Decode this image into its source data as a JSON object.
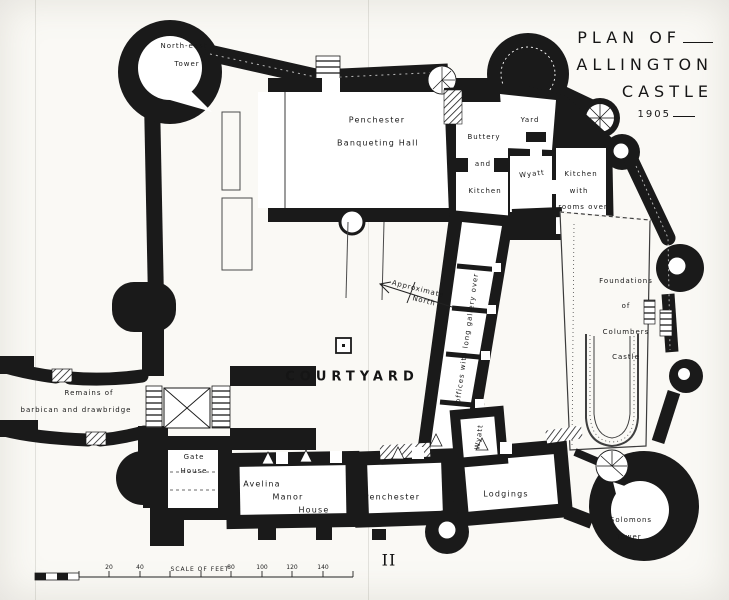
{
  "title": {
    "line1": "PLAN OF",
    "line2": "ALLINGTON",
    "line3": "CASTLE",
    "year": "1905"
  },
  "plate_number": "II",
  "colors": {
    "ink": "#1a1a1a",
    "paper": "#faf9f5"
  },
  "north_arrow": {
    "line1": "Approximate",
    "line2": "North"
  },
  "scale_bar": {
    "caption": "SCALE OF FEET",
    "tick_labels": [
      "20",
      "40",
      "80",
      "100",
      "120",
      "140"
    ]
  },
  "labels": {
    "north_east_tower": {
      "line1": "North-east",
      "line2": "Tower"
    },
    "banqueting_hall": {
      "line1": "Penchester",
      "line2": "Banqueting Hall"
    },
    "buttery": {
      "line1": "Buttery",
      "line2": "and",
      "line3": "Kitchen"
    },
    "yard": "Yard",
    "wyatt_by_kitchen": "Wyatt",
    "wyatt_kitchen": {
      "line1": "Kitchen",
      "line2": "with",
      "line3": "rooms over"
    },
    "long_gallery": "offices with long gallery over",
    "columbers_castle": {
      "line1": "Foundations",
      "line2": "of",
      "line3": "Columbers",
      "line4": "Castle"
    },
    "courtyard": "COURTYARD",
    "barbican": {
      "line1": "Remains of",
      "line2": "barbican and drawbridge"
    },
    "gate_house": {
      "line1": "Gate",
      "line2": "House"
    },
    "avelina_manor": {
      "line1": "Avelina",
      "line2": "Manor",
      "line3": "House"
    },
    "penchester_range": "Penchester",
    "lodgings": "Lodgings",
    "wyatt_room": "Wyatt",
    "solomons_tower": {
      "line1": "Solomons",
      "line2": "Tower"
    }
  }
}
